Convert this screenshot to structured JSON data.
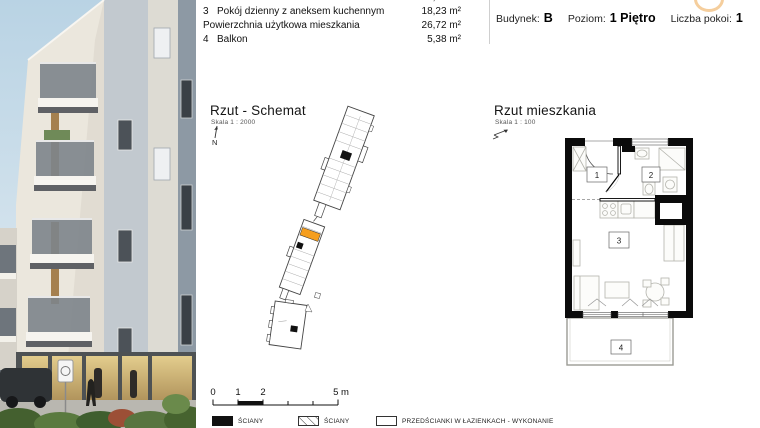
{
  "area_table": {
    "rows": [
      {
        "num": "2",
        "name": "Łazienka",
        "area": "4,54 m²"
      },
      {
        "num": "3",
        "name": "Pokój dzienny z aneksem kuchennym",
        "area": "18,23 m²"
      },
      {
        "num": "",
        "name": "Powierzchnia użytkowa mieszkania",
        "area": "26,72 m²"
      },
      {
        "num": "4",
        "name": "Balkon",
        "area": "5,38 m²"
      }
    ]
  },
  "unit_header": {
    "building_label": "Budynek:",
    "building_value": "B",
    "level_label": "Poziom:",
    "level_value": "1 Piętro",
    "rooms_label": "Liczba pokoi:",
    "rooms_value": "1"
  },
  "schematic": {
    "title": "Rzut - Schemat",
    "scale": "Skala 1 : 2000",
    "north": "N",
    "highlight_color": "#F59E1E"
  },
  "floorplan": {
    "title": "Rzut mieszkania",
    "scale": "Skala 1 : 100",
    "labels": {
      "hall": "1",
      "bath": "2",
      "living": "3",
      "balcony": "4"
    }
  },
  "scale_bar": {
    "tick_labels": [
      "0",
      "1",
      "2",
      "5 m"
    ]
  },
  "legend": {
    "items": [
      {
        "label": "ŚCIANY"
      },
      {
        "label": "ŚCIANY"
      },
      {
        "label": "PRZEDŚCIANKI W ŁAZIENKACH - WYKONANIE"
      }
    ]
  }
}
